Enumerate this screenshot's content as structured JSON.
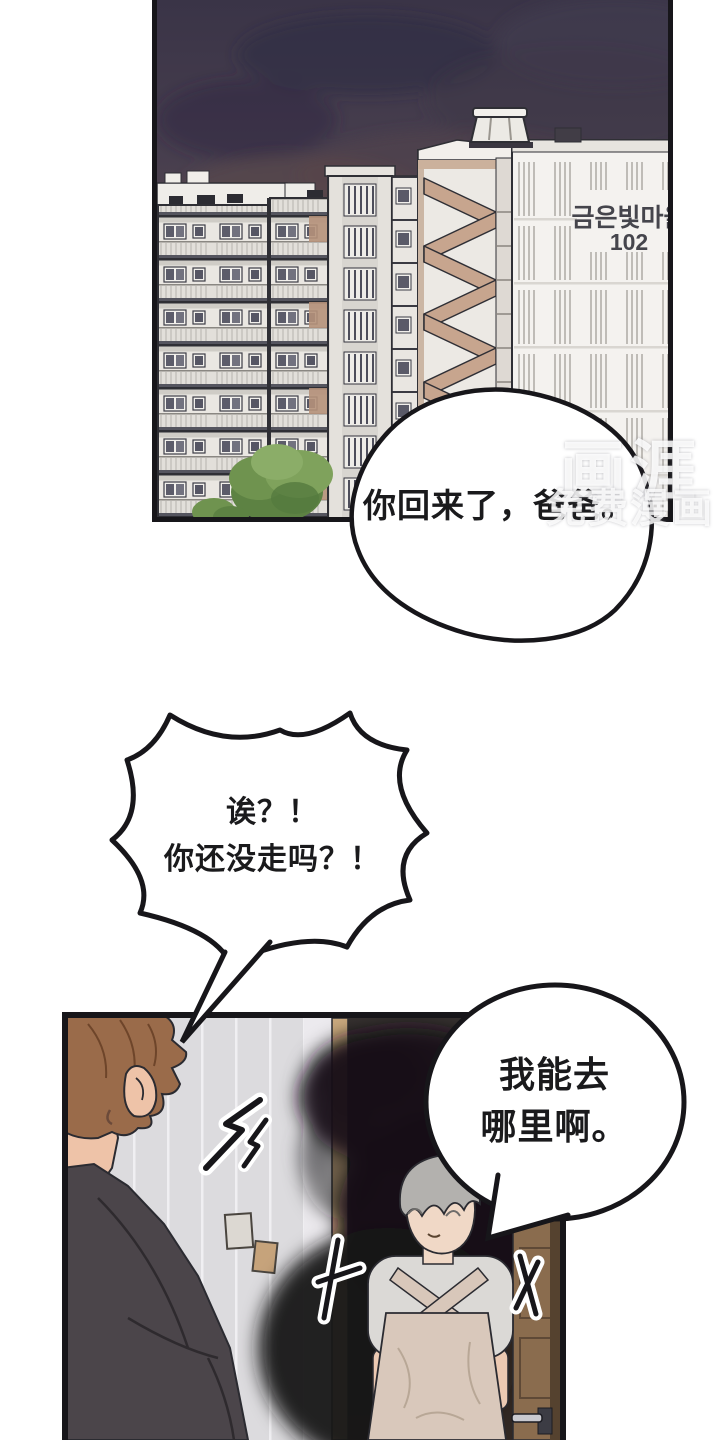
{
  "page": {
    "width": 720,
    "height": 1440,
    "background": "#ffffff",
    "description": "Two-panel manhwa page: dusk apartment cityscape above, interior doorway scene below"
  },
  "city_panel": {
    "sign": {
      "line1": "금은빛마을",
      "line2": "102"
    }
  },
  "speech": {
    "bubble1": {
      "text": "你回来了，爸爸。"
    },
    "bubble2": {
      "line1": "诶？！",
      "line2": "你还没走吗？！"
    },
    "bubble3": {
      "line1": "我能去",
      "line2": "哪里啊。"
    }
  },
  "watermark": {
    "logo": "画涯",
    "tagline": "免费漫画"
  },
  "colors": {
    "sky_top": "#3a3447",
    "sky_horizon": "#8f6b58",
    "building_cream": "#eae7e2",
    "building_tan": "#c7a58e",
    "interior_wall": "#dcdbde",
    "door_wood": "#c9a87d",
    "shadow_black": "#141216",
    "hair_brown": "#9a6b4a",
    "hair_gray": "#b3b1ae",
    "jacket_dark": "#4b454a",
    "apron_beige": "#d9c8bb",
    "outline": "#2b2b31"
  }
}
